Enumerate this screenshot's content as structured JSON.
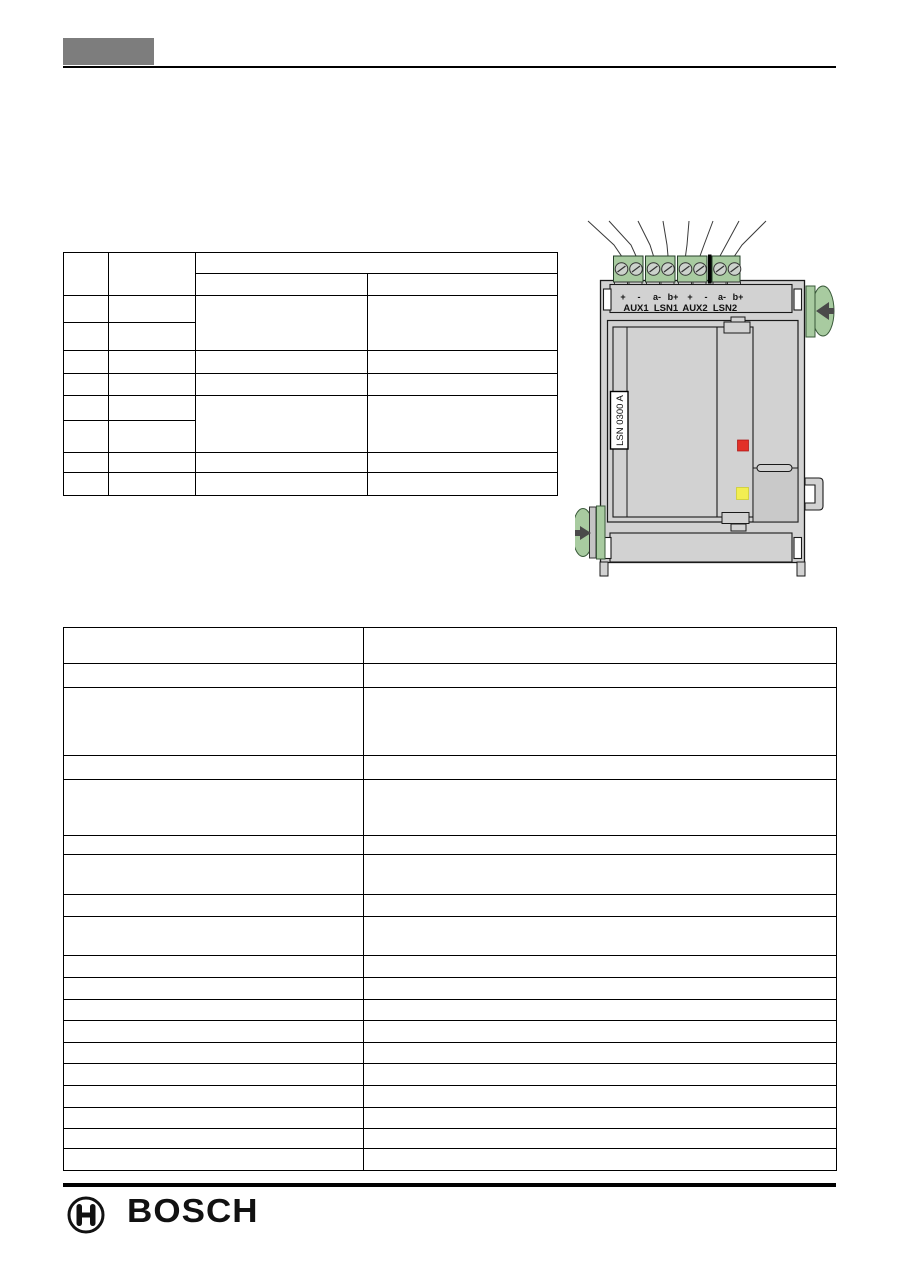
{
  "diagram": {
    "model_label": "LSN 0300 A",
    "terminal_signs": [
      "+",
      "-",
      "a-",
      "b+",
      "+",
      "-",
      "a-",
      "b+"
    ],
    "terminal_names": [
      "AUX1",
      "LSN1",
      "AUX2",
      "LSN2"
    ],
    "colors": {
      "body_gray": "#d2d2d2",
      "panel_gray": "#c9c9c9",
      "clip_green": "#a8cba0",
      "screw_gray": "#ccd2cc",
      "led_red": "#e23128",
      "led_yellow": "#f2ee52"
    }
  },
  "footer": {
    "brand": "BOSCH"
  }
}
